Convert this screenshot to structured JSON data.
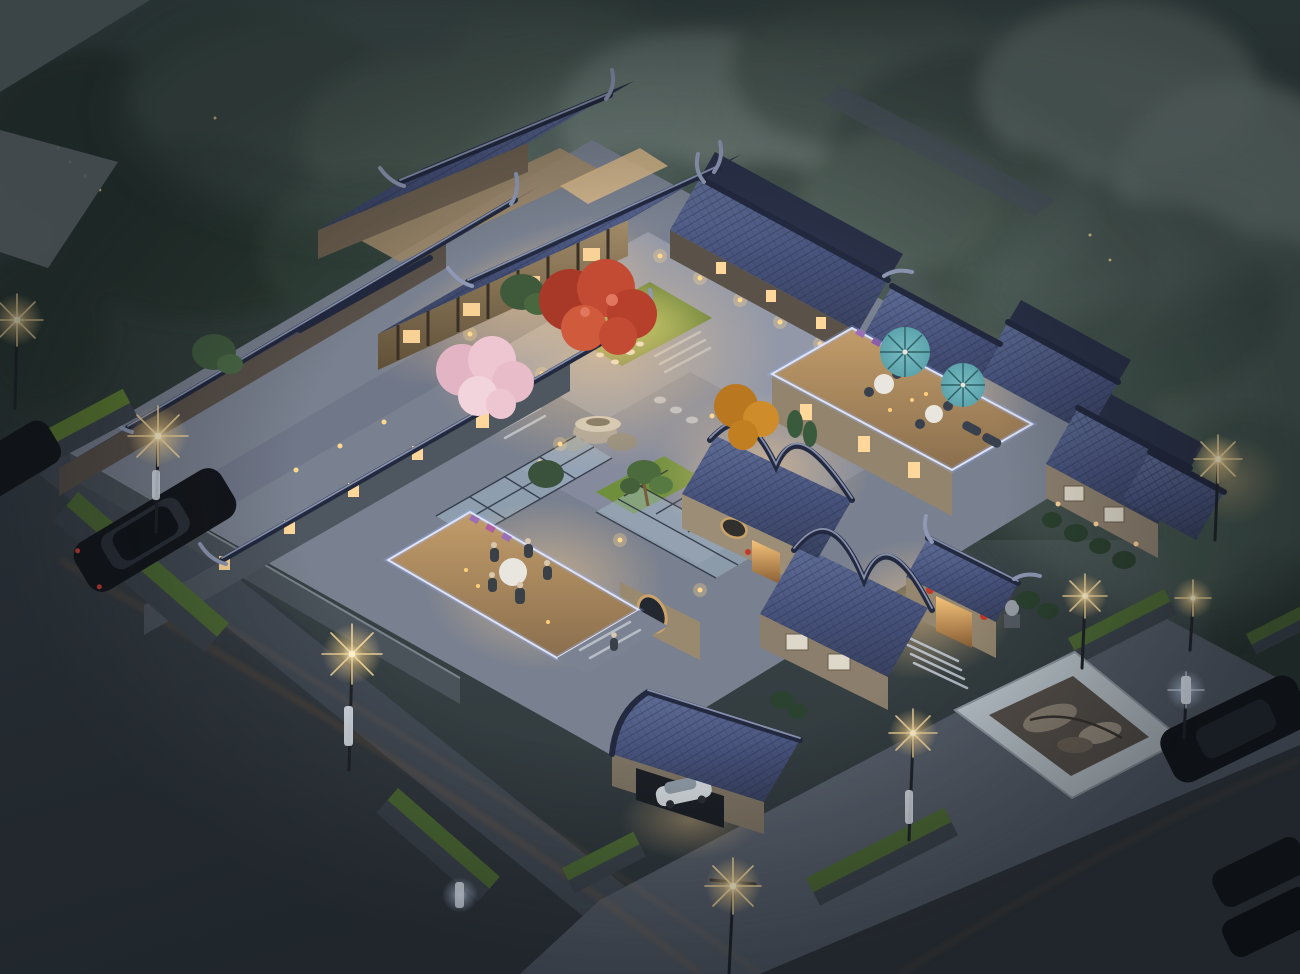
{
  "scene": {
    "type": "architectural-rendering",
    "subject": "traditional chinese siheyuan courtyard residence",
    "time_of_day": "dusk",
    "view": "aerial-birds-eye",
    "lighting": "warm interior and lantern lighting against blue evening mist",
    "features": [
      "grey-tiled roofs with upturned eaves",
      "central courtyard with red maple tree",
      "pink cherry-blossom tree",
      "orange autumn tree",
      "lawn with stepping stones",
      "white rockery stone table",
      "rooftop terrace with two teal umbrellas",
      "rooftop dining terrace with guests at round table",
      "glass skylight corridors",
      "led-lit terrace parapets",
      "main gate with stone lion and red lanterns",
      "carport with silver car",
      "street with dark sedan",
      "raised lawn planters",
      "glowing street lamps",
      "white marble reflecting pool with rocks",
      "parked dark cars along right road",
      "misty forest backdrop",
      "fireflies in trees"
    ],
    "counts": {
      "umbrellas": 2,
      "street_lamps_warm": 8,
      "street_lamps_cool": 2,
      "cars_street": 2,
      "cars_parked_right": 3,
      "diners_at_table": 5
    }
  },
  "palette": {
    "skyTop": "#45534f",
    "ground": "#2e363c",
    "forestDark": "#2a3731",
    "forestPale": "#6f7f7b",
    "roofHi": "#5f6d96",
    "roofMid": "#46517a",
    "roofLo": "#38415f",
    "roofBack": "#2b3249",
    "ridgeDark": "#232a40",
    "ridgeLight": "#929cba",
    "baseStone": "#79808f",
    "courtPaving": "#9298a8",
    "courtPaving2": "#858b9c",
    "wallGray": "#4e565f",
    "wallBeige": "#8d8070",
    "woodWarm": "#8a7456",
    "windowWarm": "#ffd79a",
    "glowWarm": "#ffcf8e",
    "lanternRed": "#c43a2a",
    "ledCool": "#dfe9ff",
    "glass": "#a3bccd",
    "deckWood": "#c29c6a",
    "lawn": "#5f7e33",
    "lawnBright": "#9dbb4e",
    "street": "#3a424a",
    "sidewalk": "#454e58",
    "plaza": "#565e6a",
    "road": "#30363c",
    "marble": "#bcc6cd",
    "rock": "#8f8577",
    "blossomPink": "#eec6d2",
    "mapleRed": "#c44b33",
    "orangeTree": "#cf8c2a",
    "bonsaiGreen": "#4c6b3c",
    "umbrellaTeal": "#5ca3ab",
    "tableWhite": "#e9e6df",
    "carDark": "#14171c",
    "carSilver": "#cfd5da",
    "flowerPurple": "#9b6fb5"
  }
}
